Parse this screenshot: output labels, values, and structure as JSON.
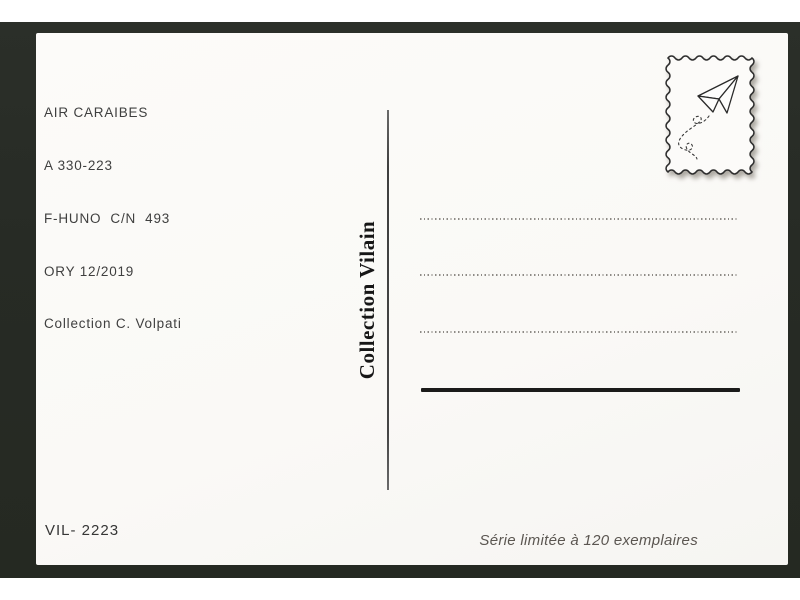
{
  "postcard": {
    "info_block": {
      "lines": [
        "AIR CARAIBES",
        "A 330-223",
        "F-HUNO  C/N  493",
        "ORY 12/2019",
        "Collection C. Volpati"
      ]
    },
    "publisher_vertical_label": "Collection Vilain",
    "stamp": {
      "icon": "paper-plane",
      "border_style": "wavy-stamp-frame",
      "trail": "dashed-loop"
    },
    "address_area": {
      "dotted_line_count": 3,
      "has_bottom_solid_line": true
    },
    "catalog_number": "VIL- 2223",
    "edition_note": "Série limitée à 120 exemplaires",
    "colors": {
      "frame_background": "#282c26",
      "card_background": "#fbfaf8",
      "text_primary": "#3f3f3f",
      "publisher_text": "#161616",
      "dotted_line": "#8e8b86",
      "solid_line": "#1b1b1a",
      "edition_text": "#5b5651"
    }
  }
}
